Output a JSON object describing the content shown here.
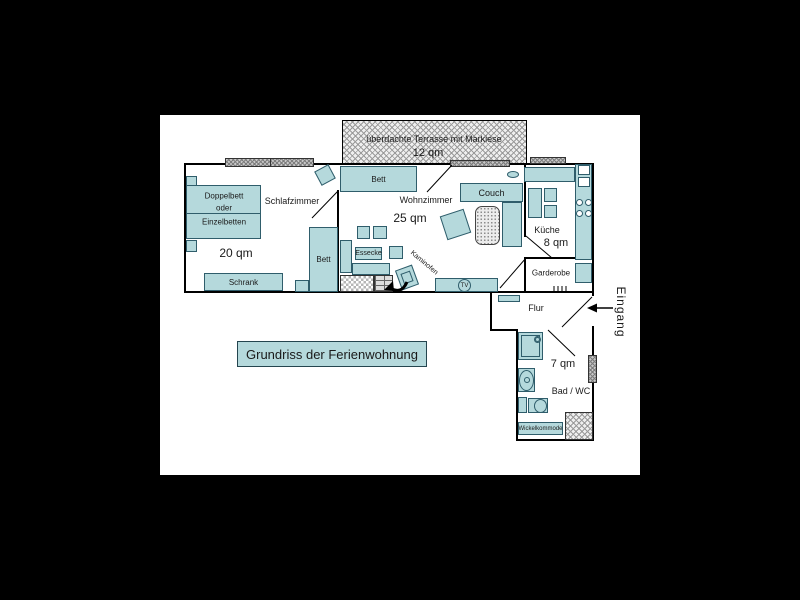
{
  "title": "Grundriss der Ferienwohnung",
  "entrance": {
    "label": "Eingang"
  },
  "terrace": {
    "label": "überdachte Terrasse mit Markiese",
    "area": "12 qm"
  },
  "rooms": {
    "schlafzimmer": {
      "name": "Schlafzimmer",
      "area": "20 qm"
    },
    "wohnzimmer": {
      "name": "Wohnzimmer",
      "area": "25 qm"
    },
    "kueche": {
      "name": "Küche",
      "area": "8 qm"
    },
    "garderobe": {
      "name": "Garderobe"
    },
    "flur": {
      "name": "Flur"
    },
    "bad": {
      "name": "Bad / WC",
      "area": "7 qm"
    }
  },
  "furniture": {
    "doppelbett_line1": "Doppelbett",
    "doppelbett_line2": "oder",
    "doppelbett_line3": "Einzelbetten",
    "schrank": "Schrank",
    "bett_schlafzimmer": "Bett",
    "bett_wohnzimmer": "Bett",
    "couch": "Couch",
    "essecke": "Essecke",
    "kaminofen": "Kaminofen",
    "tv": "TV",
    "wickelkommode": "Wickelkommode"
  },
  "colors": {
    "background": "#000000",
    "canvas": "#ffffff",
    "wall": "#000000",
    "furniture_fill": "#b5d9dc",
    "furniture_border": "#2f5d6b"
  }
}
